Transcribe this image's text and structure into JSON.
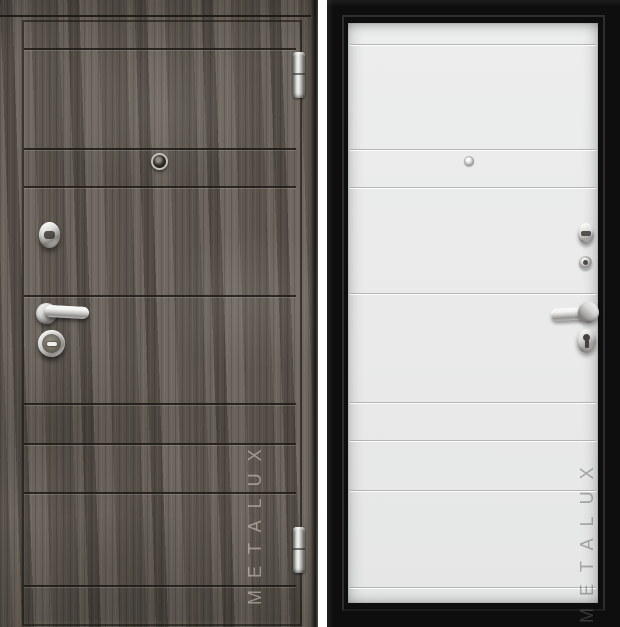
{
  "brand": {
    "name": "METALUX"
  },
  "product": {
    "type": "steel entry door, two views side by side",
    "panels": [
      {
        "id": "front",
        "view": "exterior side",
        "finish": "dark grey oak woodgrain with horizontal grooves"
      },
      {
        "id": "back",
        "view": "interior side",
        "finish": "matte white horizontal panels inside black steel frame"
      }
    ]
  },
  "left_door": {
    "watermark": "METALUX",
    "hardware": [
      "peephole",
      "upper-lock-escutcheon",
      "lever-handle",
      "lower-lock-cylinder",
      "hinge-top",
      "hinge-bottom"
    ]
  },
  "right_door": {
    "watermark": "METALUX",
    "hardware": [
      "peephole-back",
      "night-latch-thumbturn",
      "lock-escutcheon",
      "lever-handle",
      "keyhole-cover"
    ]
  },
  "colors": {
    "background": "#ffffff",
    "wood_base": "#665f58",
    "wood_dark": "#4e4840",
    "wood_light": "#847c72",
    "groove_dark": "#35302a",
    "white_leaf": "#e9eae9",
    "white_groove": "#c9cbca",
    "frame_black": "#0e0e0e",
    "chrome_light": "#f2f2f2",
    "chrome_dark": "#8e8e8e",
    "watermark_on_wood": "#a39d94",
    "watermark_on_white": "#b6b8b7"
  }
}
